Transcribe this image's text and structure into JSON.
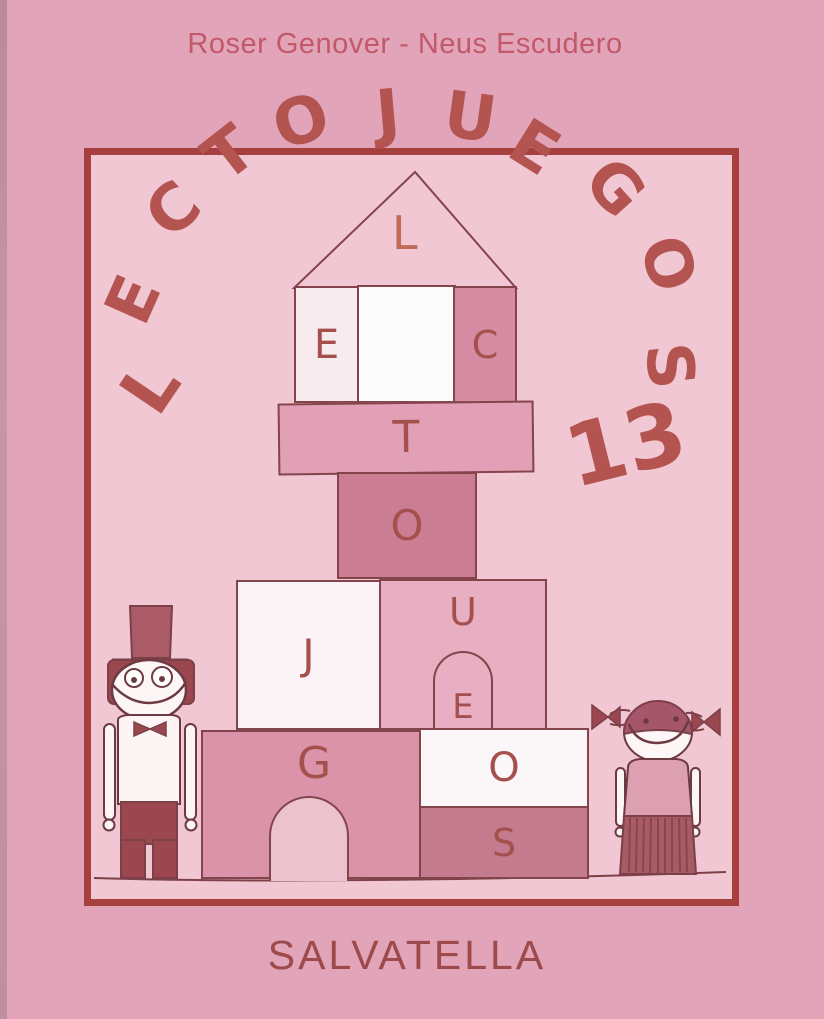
{
  "header": {
    "authors": "Roser Genover - Neus Escudero"
  },
  "title": {
    "arc_letters": [
      "L",
      "E",
      "C",
      "T",
      "O",
      "J",
      "U",
      "E",
      "G",
      "O",
      "S"
    ],
    "volume": "13"
  },
  "blocks": {
    "roof_letter": "L",
    "row1_left_letter": "E",
    "row1_right_letter": "C",
    "bar_letter": "T",
    "square_letter": "O",
    "row2_left_letter": "J",
    "row2_right_letter": "U",
    "window_letter": "E",
    "big_block_letter": "G",
    "white_block_letter": "O",
    "dark_block_letter": "S"
  },
  "footer": {
    "publisher": "SALVATELLA"
  },
  "colors": {
    "outer_background": "#e2a4b8",
    "inner_background": "#f1c7d4",
    "frame_border": "#a6403e",
    "title_red": "#b45450",
    "authors_text": "#c2586a",
    "publisher_text": "#9d4a4c",
    "outline": "#84444c",
    "figure_dark_red": "#9c4750"
  }
}
